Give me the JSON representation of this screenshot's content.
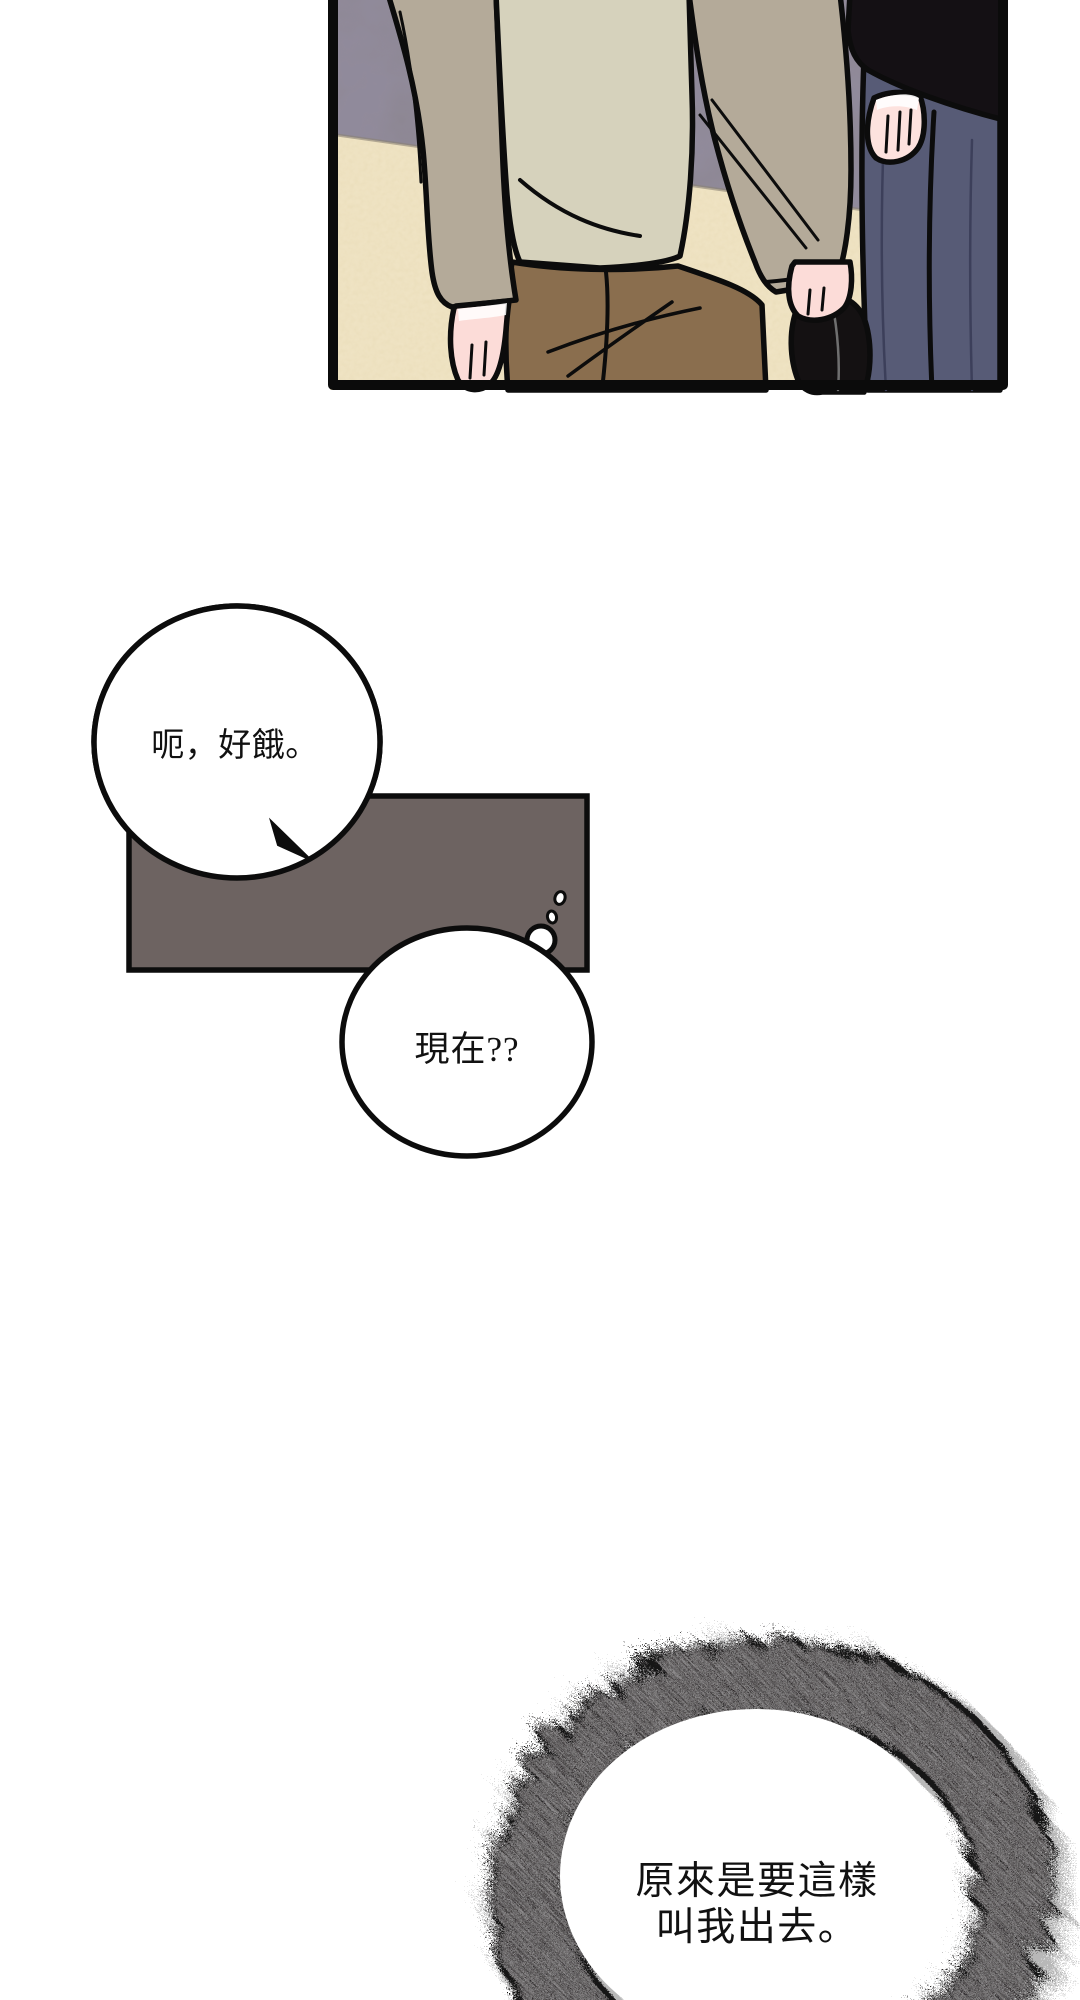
{
  "page": {
    "width": 1080,
    "height": 2000,
    "background": "#ffffff"
  },
  "panel": {
    "description": "webtoon panel: two standing figures cropped at torso, gray wall and beige floor",
    "wall_color": "#8d8793",
    "floor_color": "#efe3c3",
    "outline_color": "#0c0c0c",
    "left_figure": {
      "jacket_color": "#b4aa99",
      "shirt_color": "#d6d2bc",
      "pants_color": "#8a6e4e",
      "skin_color": "#fcdcd8",
      "held_item_color": "#141112"
    },
    "right_figure": {
      "jacket_color": "#141014",
      "pants_color": "#575b76",
      "skin_color": "#fde2de"
    }
  },
  "speech_bubbles": [
    {
      "id": "bubble-1",
      "text": "呃，好餓。",
      "shape": "ellipse",
      "fill": "#ffffff"
    },
    {
      "id": "bubble-2",
      "text": "現在??",
      "shape": "ellipse",
      "fill": "#ffffff"
    }
  ],
  "caption_box": {
    "fill": "#6d6361",
    "border": "#0c0c0c"
  },
  "burst_circle": {
    "line1": "原來是要這樣",
    "line2": "叫我出去。",
    "ring_color": "#171314",
    "inner_fill": "#ffffff"
  }
}
